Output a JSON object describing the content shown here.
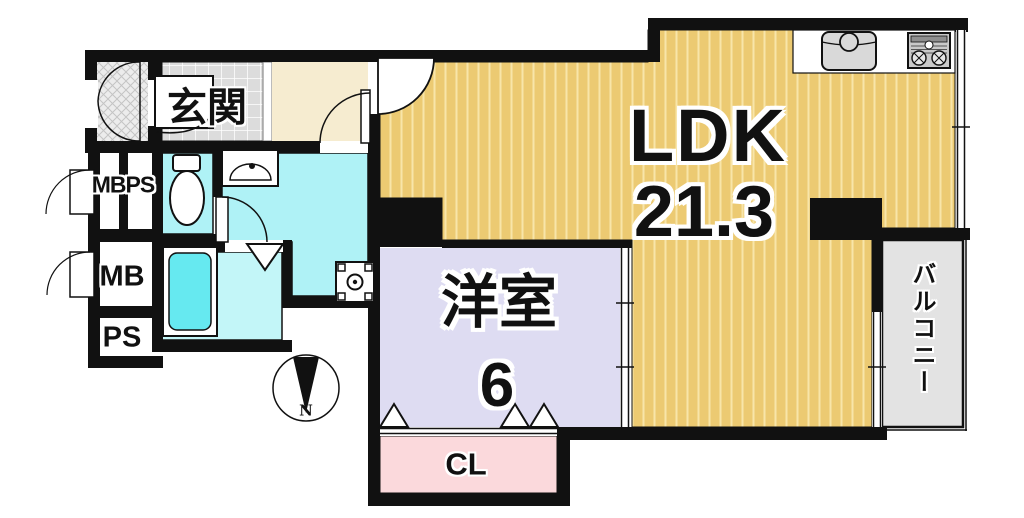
{
  "plan": {
    "rooms": {
      "genkan": {
        "name": "玄関"
      },
      "ldk": {
        "name": "LDK",
        "size": "21.3"
      },
      "western_room": {
        "name": "洋室",
        "size": "6"
      },
      "closet": {
        "name": "CL"
      },
      "balcony": {
        "name": "バルコニー"
      },
      "mbps": {
        "name": "MBPS"
      },
      "mb": {
        "name": "MB"
      },
      "ps": {
        "name": "PS"
      }
    },
    "compass": {
      "north_label": "N"
    },
    "colors": {
      "wall": "#111111",
      "ldk_floor": "#ecca72",
      "ldk_stripe": "#f8e5a9",
      "western_room_floor": "#dedcf2",
      "closet_floor": "#fbd9dc",
      "wet_area_floor": "#aff2f6",
      "bathtub": "#66e9f0",
      "genkan_tile": "#dcdcdc",
      "hallway_floor": "#f6ecd0",
      "balcony_floor": "#e3e3e3"
    },
    "icons": [
      "kitchen-sink-icon",
      "gas-stove-icon",
      "toilet-icon",
      "washbasin-icon",
      "washing-machine-icon",
      "bathtub-icon",
      "compass-icon",
      "door-swing-arc",
      "folding-door-triangle"
    ]
  }
}
